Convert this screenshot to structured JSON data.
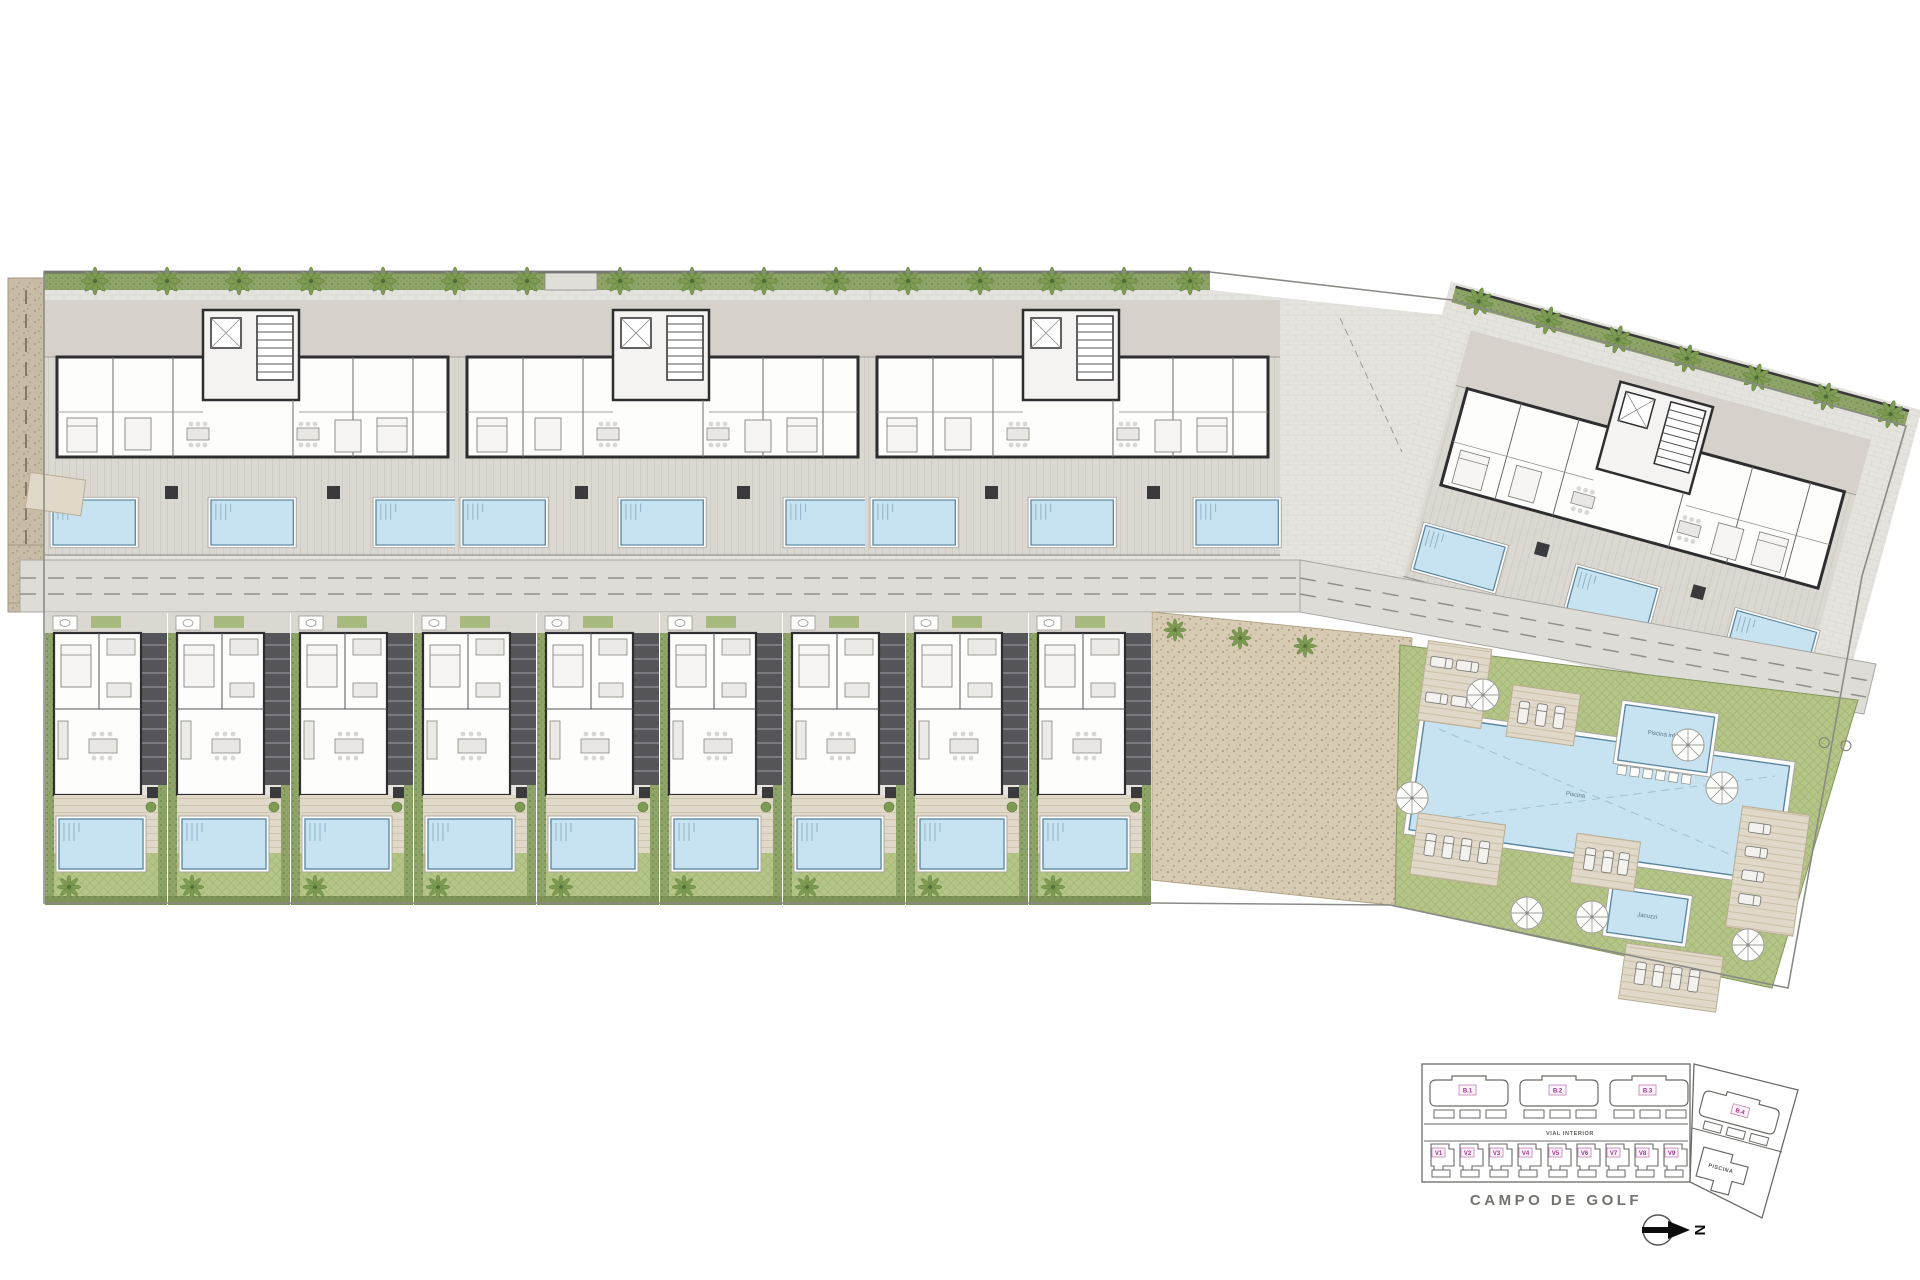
{
  "keyplan": {
    "road_label": "VIAL INTERIOR",
    "golf_label": "CAMPO DE GOLF",
    "piscina_label": "PISCINA",
    "north_label": "N",
    "blocks": [
      "B.1",
      "B.2",
      "B.3",
      "B.4"
    ],
    "villas": [
      "V1",
      "V2",
      "V3",
      "V4",
      "V5",
      "V6",
      "V7",
      "V8",
      "V9"
    ]
  },
  "amenities": {
    "main_pool_label": "Piscina",
    "kids_pool_label": "Piscina infantil",
    "jacuzzi_label": "Jacuzzi"
  },
  "colors": {
    "pool_water": "#c7e2f0",
    "pool_edge": "#5b859e",
    "lawn_green": "#b5c487",
    "hedge_green": "#8fa468",
    "tree_green": "#7d9b52",
    "pavement_grey": "#e5e3de",
    "terrace_grey": "#dbd7d1",
    "deck_tan": "#e0d8c8",
    "wall_dark": "#2e2e30",
    "gravel_tan": "#c9bca6",
    "label_pink": "#a4338f",
    "text_grey": "#73736f"
  }
}
